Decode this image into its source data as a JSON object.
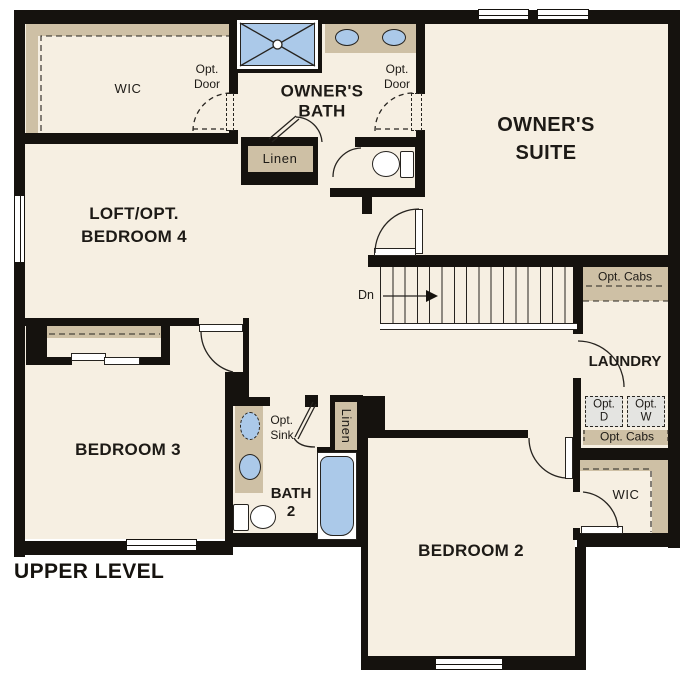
{
  "title": "UPPER LEVEL",
  "colors": {
    "floor": "#f6efe2",
    "wall": "#15120e",
    "cabinet_tan": "#cec0a5",
    "fixture_blue": "#abc9e9",
    "appliance_gray": "#e4e4e1",
    "outside": "#ffffff"
  },
  "labels": {
    "wic_owner": "WIC",
    "opt_door_wic": "Opt.\nDoor",
    "owners_bath": "OWNER'S\nBATH",
    "opt_door_suite": "Opt.\nDoor",
    "owners_suite": "OWNER'S\nSUITE",
    "linen_owner": "Linen",
    "loft": "LOFT/OPT.\nBEDROOM 4",
    "stairs_dn": "Dn",
    "opt_cabs_upper": "Opt. Cabs",
    "laundry": "LAUNDRY",
    "opt_dryer": "Opt.\nD",
    "opt_washer": "Opt.\nW",
    "opt_cabs_lower": "Opt. Cabs",
    "wic_bed2": "WIC",
    "bedroom3": "BEDROOM 3",
    "opt_sink": "Opt.\nSink",
    "bath2": "BATH\n2",
    "linen_bath2": "Linen",
    "bedroom2": "BEDROOM 2"
  },
  "icons": {
    "shower": "blue pan with X drain lines",
    "sink": "blue oval basin",
    "toilet": "oval bowl with tank",
    "tub": "blue rounded rectangle",
    "stairs": "treads with Dn arrow",
    "window": "white double-line in wall",
    "door": "leaf with quarter-circle swing arc",
    "optional-door": "dashed leaf and dashed arc"
  }
}
